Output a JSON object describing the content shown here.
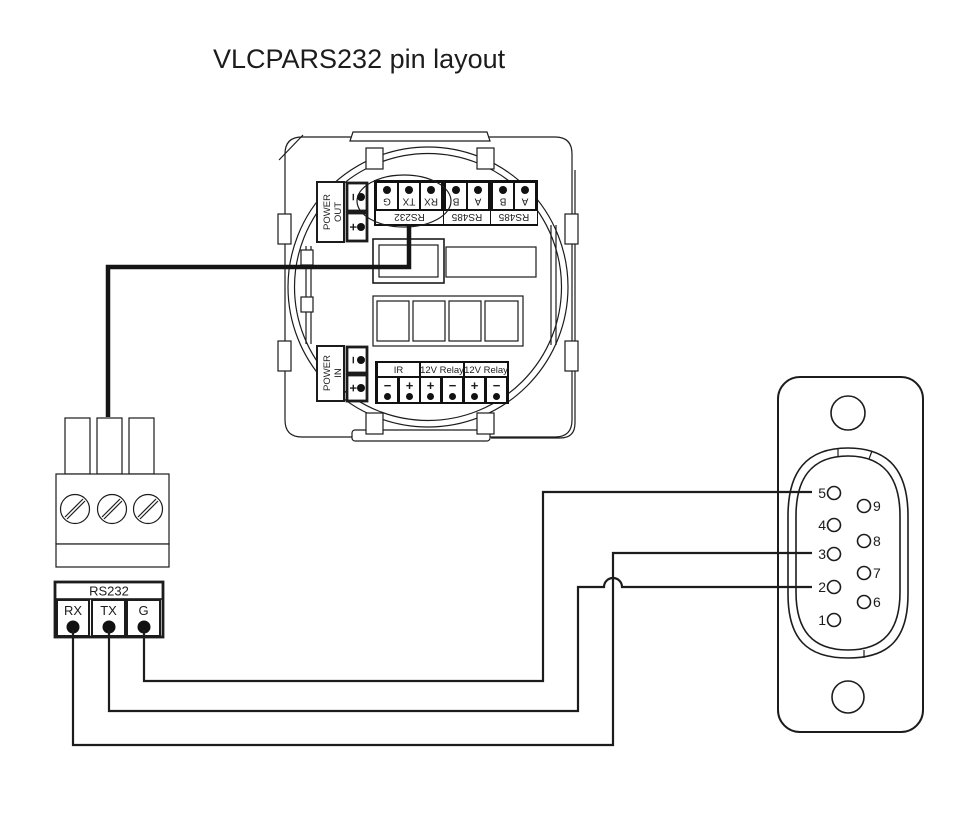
{
  "title": "VLCPARS232 pin layout",
  "colors": {
    "line": "#1c1c1c",
    "terminal_fill": "#111111",
    "background": "#ffffff"
  },
  "module": {
    "power_out": {
      "label_line1": "POWER",
      "label_line2": "OUT",
      "minus": "−",
      "plus": "+"
    },
    "power_in": {
      "label_line1": "POWER",
      "label_line2": "IN",
      "minus": "−",
      "plus": "+"
    },
    "top_strip": {
      "pins": [
        "G",
        "TX",
        "RX",
        "B",
        "A",
        "B",
        "A"
      ],
      "groups": [
        "RS232",
        "RS485",
        "RS485"
      ]
    },
    "bottom_strip": {
      "groups": [
        {
          "label": "IR",
          "pins": [
            "−",
            "+"
          ]
        },
        {
          "label": "12V Relay",
          "pins": [
            "+",
            "−"
          ]
        },
        {
          "label": "12V Relay",
          "pins": [
            "+",
            "−"
          ]
        }
      ]
    }
  },
  "breakout": {
    "header": "RS232",
    "pins": [
      "RX",
      "TX",
      "G"
    ]
  },
  "db9": {
    "left_pins": [
      "5",
      "4",
      "3",
      "2",
      "1"
    ],
    "right_pins": [
      "9",
      "8",
      "7",
      "6"
    ]
  },
  "connections": [
    {
      "from": "G",
      "to_db9_pin": "5"
    },
    {
      "from": "TX",
      "to_db9_pin": "2"
    },
    {
      "from": "RX",
      "to_db9_pin": "3"
    }
  ]
}
